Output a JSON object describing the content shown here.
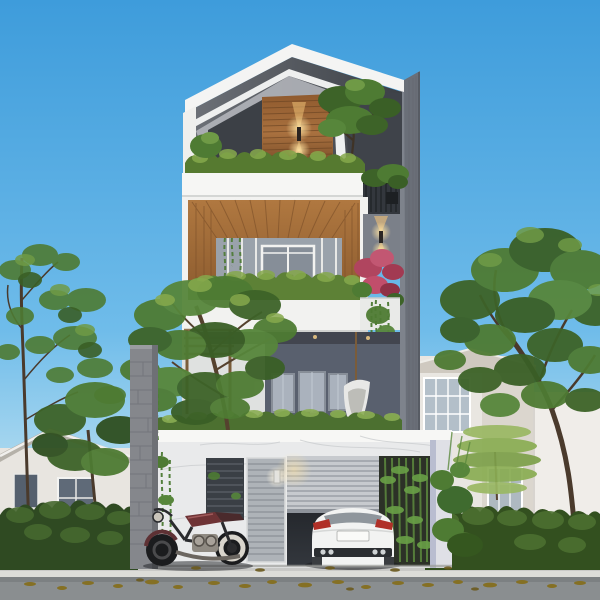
{
  "scene": {
    "description": "Photorealistic render of a modern four-storey townhouse at dusk: angular white folded roof over a wood-clad roof terrace with glowing wall lamp and tree, wood-lined third-floor balcony with glass doors and planter hedges, gray second floor with windows and white hanging chair, white marble ground floor with louvered entry, half-open roller garage door revealing a white sports car and bamboo light-well, vintage maroon motorcycle parked outside, flanked by green trees, hedges and neighboring houses, leaf-strewn sidewalk and road in front, clear blue gradient sky.",
    "palette": {
      "sky_top": "#3E9CDB",
      "sky_mid": "#6FBCEA",
      "sky_horizon": "#D6EDF3",
      "facade_white": "#F2F2F0",
      "slab_white": "#F6F6F4",
      "roof_under": "#4E5258",
      "terrace_dark": "#3F434A",
      "wood_light": "#A9713F",
      "wood_dark": "#7A4E28",
      "tower_gray": "#6A6F78",
      "wall_gray": "#59606E",
      "window_glass": "#AAB2BD",
      "frame_gray": "#8D949E",
      "marble": "#E9EAEB",
      "concrete": "#85878C",
      "hedge_dark": "#2F4A22",
      "hedge_mid": "#4C7030",
      "leaf_light": "#86A94C",
      "tree_green": "#4E7B33",
      "tree_dark": "#3A5F26",
      "flower_pink": "#C14E6B",
      "lamp_warm": "#F6C87C",
      "roller_gray": "#C7CACE",
      "interior_dark": "#24272C",
      "bamboo_green": "#5D8A3E",
      "car_white": "#F2F3F2",
      "tail_red": "#B03028",
      "moto_maroon": "#6E3335",
      "sidewalk": "#BEBFBF",
      "road": "#8A8E90",
      "leaf_brown": "#857024",
      "bg_house": "#E8E5E0"
    },
    "objects": [
      "folded white roof canopy",
      "roof terrace with wood feature wall and up-down lamp",
      "terrace tree and shrub planter",
      "wood-framed third-floor balcony with glass doors",
      "pink flowering planter and hanging vines",
      "gray second floor with windows and hanging chair",
      "second-floor terrace tree with pergola",
      "marble ground floor with louvered entry panels",
      "half-open roller garage door",
      "white sports car parked in garage",
      "bamboo light-well inside garage",
      "vintage maroon motorcycle on driveway",
      "concrete boundary pillar",
      "left neighborhood house with hedge and tall trees",
      "right neighborhood house, hedge, conifer and large tree",
      "bicycle by right hedge",
      "sidewalk with curb and scattered leaves",
      "asphalt road",
      "clear gradient sky"
    ]
  }
}
